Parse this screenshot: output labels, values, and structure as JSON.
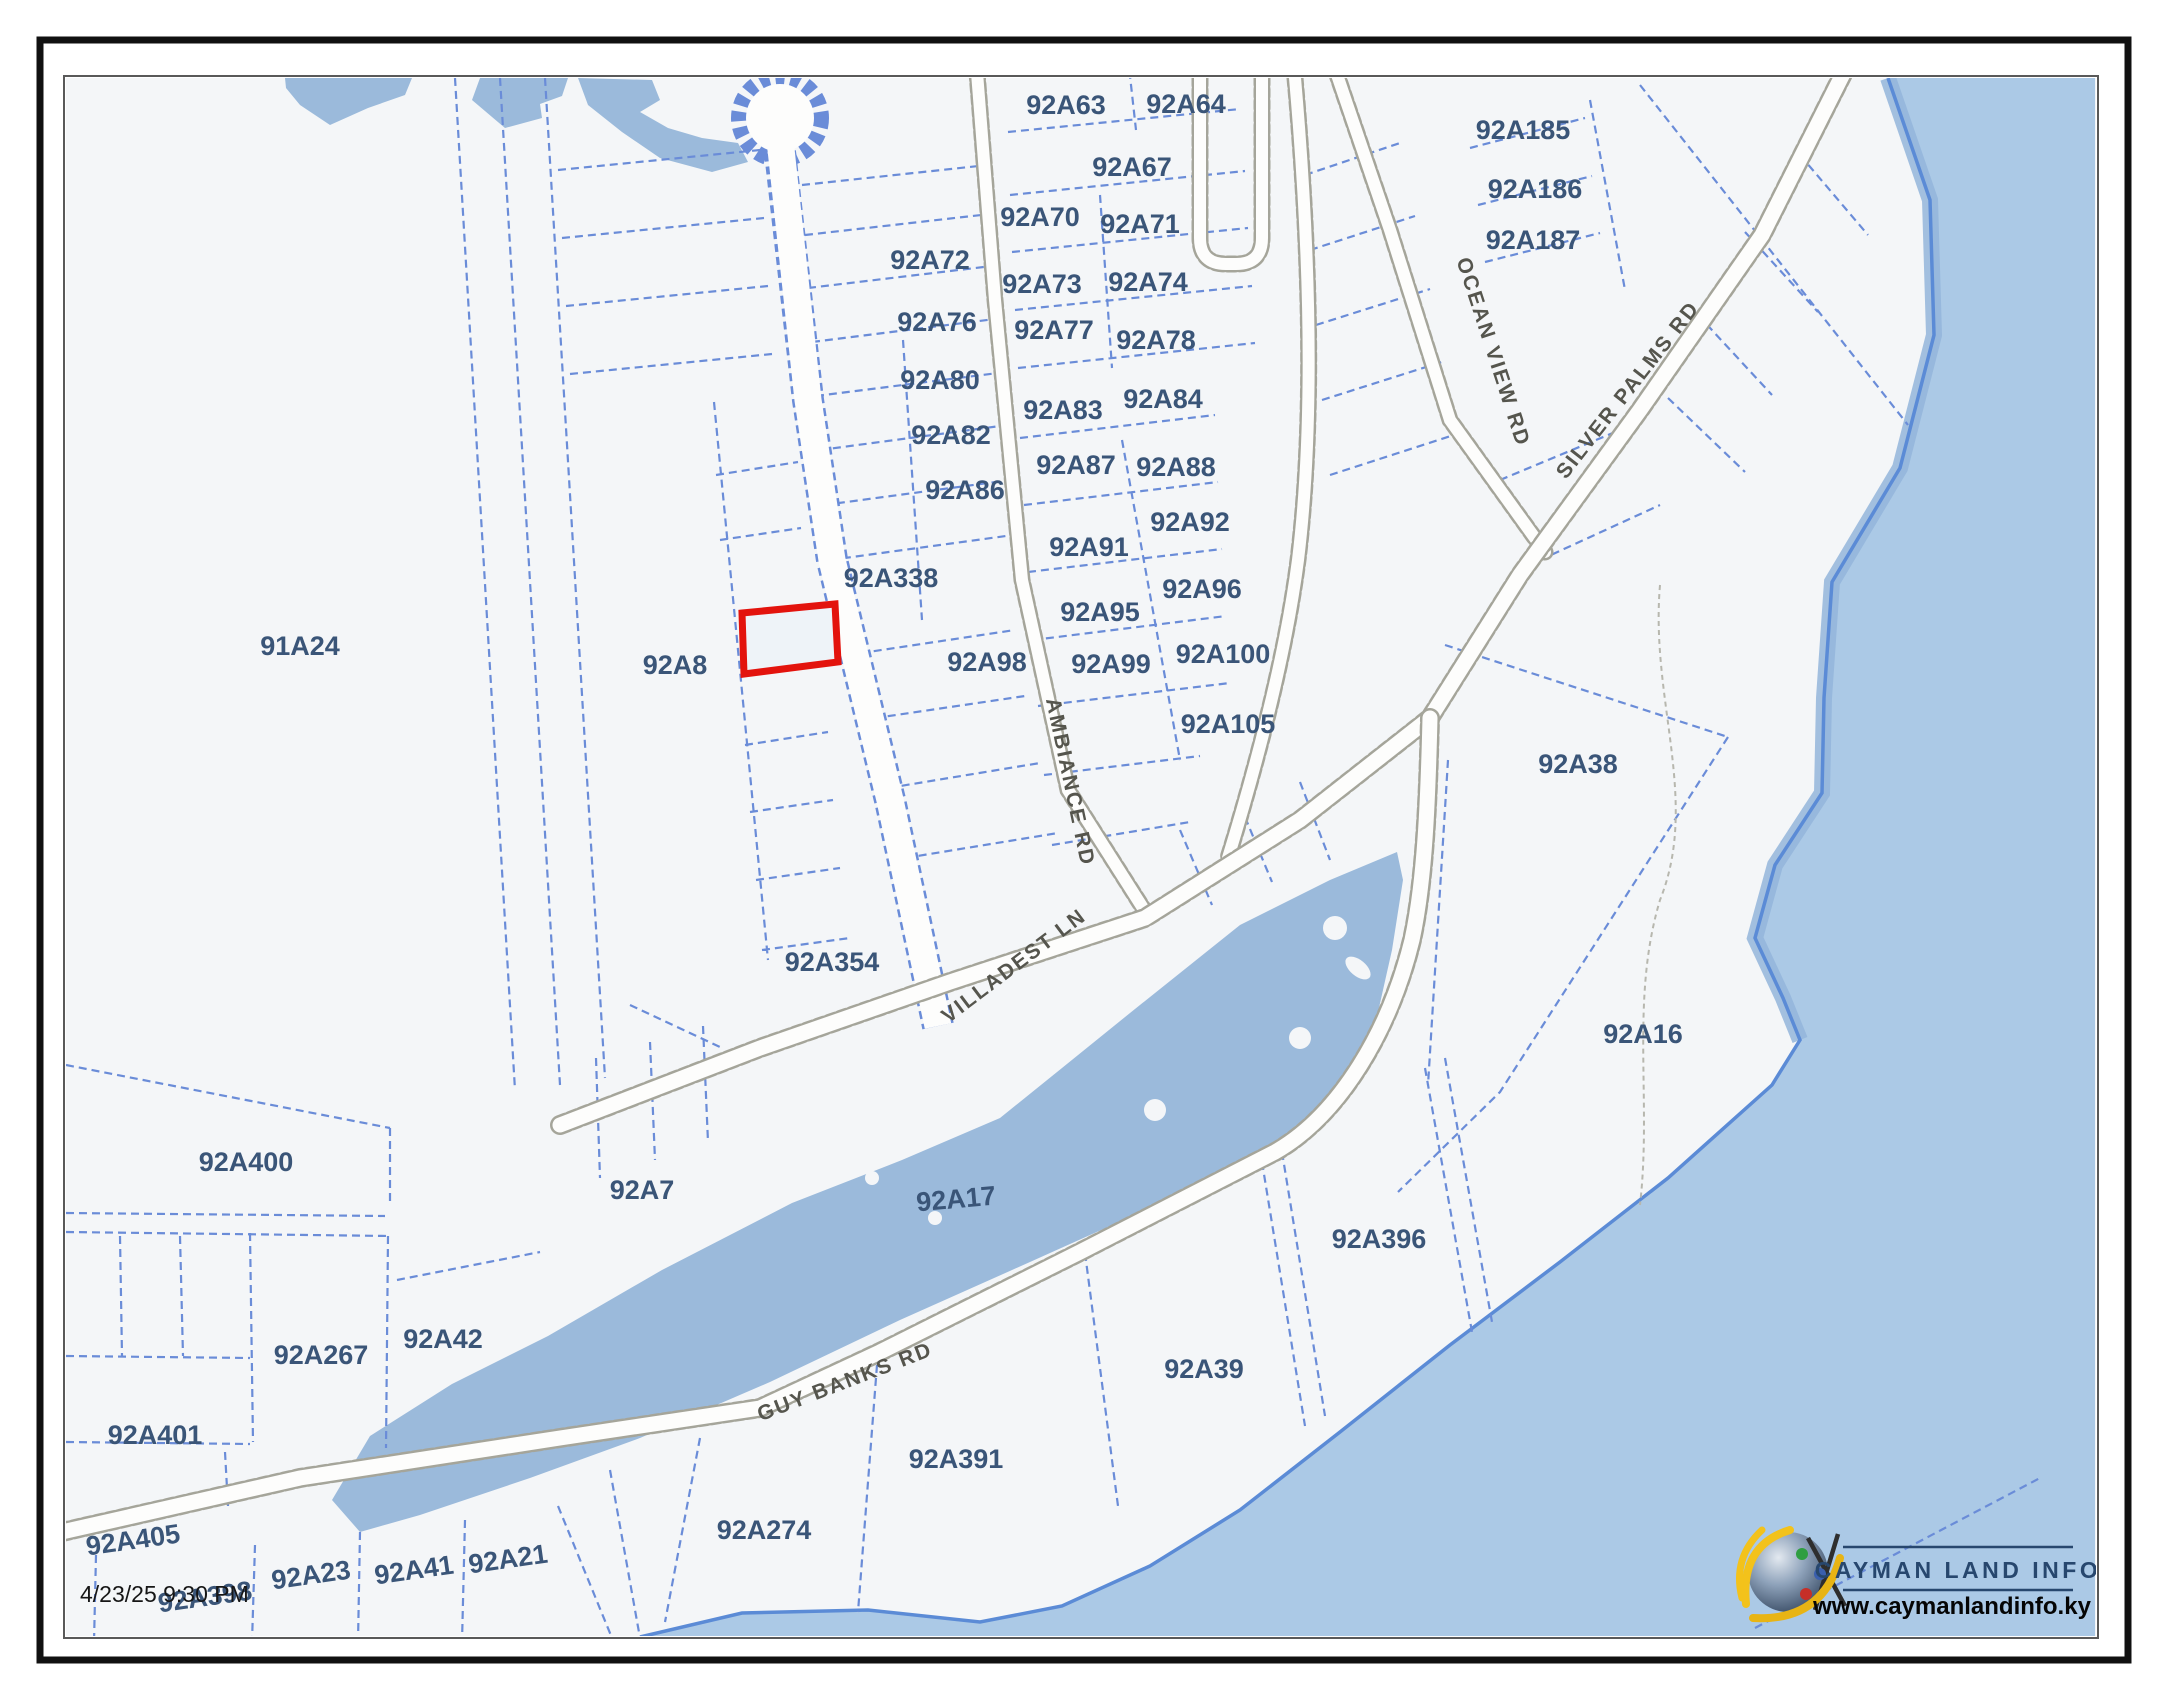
{
  "page": {
    "timestamp": "4/23/25 9:30 PM"
  },
  "map": {
    "colors": {
      "land": "#f4f6f8",
      "sea": "#abc9e6",
      "pond": "#9bbadb",
      "coastline": "#5b8bd6",
      "shore-band": "#93b5da",
      "parcel-line": "#6a8cd8",
      "road-casing": "#a5a59a",
      "road-fill": "#fdfdfc",
      "parcel-label": "#3a5578",
      "road-label": "#55554d",
      "highlight": "#e3130d",
      "frame": "#595959",
      "border": "#111111"
    },
    "highlight_parcel": {
      "points": "742,613 835,604 838,662 744,674"
    },
    "parcel_labels": [
      {
        "id": "91A24",
        "x": 300,
        "y": 646
      },
      {
        "id": "92A8",
        "x": 675,
        "y": 665
      },
      {
        "id": "92A338",
        "x": 891,
        "y": 578
      },
      {
        "id": "92A354",
        "x": 832,
        "y": 962
      },
      {
        "id": "92A63",
        "x": 1066,
        "y": 105
      },
      {
        "id": "92A64",
        "x": 1186,
        "y": 104
      },
      {
        "id": "92A67",
        "x": 1132,
        "y": 167
      },
      {
        "id": "92A70",
        "x": 1040,
        "y": 217
      },
      {
        "id": "92A71",
        "x": 1140,
        "y": 224
      },
      {
        "id": "92A72",
        "x": 930,
        "y": 260
      },
      {
        "id": "92A73",
        "x": 1042,
        "y": 284
      },
      {
        "id": "92A74",
        "x": 1148,
        "y": 282
      },
      {
        "id": "92A76",
        "x": 937,
        "y": 322
      },
      {
        "id": "92A77",
        "x": 1054,
        "y": 330
      },
      {
        "id": "92A78",
        "x": 1156,
        "y": 340
      },
      {
        "id": "92A80",
        "x": 940,
        "y": 380
      },
      {
        "id": "92A82",
        "x": 951,
        "y": 435
      },
      {
        "id": "92A83",
        "x": 1063,
        "y": 410
      },
      {
        "id": "92A84",
        "x": 1163,
        "y": 399
      },
      {
        "id": "92A86",
        "x": 965,
        "y": 490
      },
      {
        "id": "92A87",
        "x": 1076,
        "y": 465
      },
      {
        "id": "92A88",
        "x": 1176,
        "y": 467
      },
      {
        "id": "92A91",
        "x": 1089,
        "y": 547
      },
      {
        "id": "92A92",
        "x": 1190,
        "y": 522
      },
      {
        "id": "92A95",
        "x": 1100,
        "y": 612
      },
      {
        "id": "92A96",
        "x": 1202,
        "y": 589
      },
      {
        "id": "92A98",
        "x": 987,
        "y": 662
      },
      {
        "id": "92A99",
        "x": 1111,
        "y": 664
      },
      {
        "id": "92A100",
        "x": 1223,
        "y": 654
      },
      {
        "id": "92A105",
        "x": 1228,
        "y": 724
      },
      {
        "id": "92A185",
        "x": 1523,
        "y": 130
      },
      {
        "id": "92A186",
        "x": 1535,
        "y": 189
      },
      {
        "id": "92A187",
        "x": 1533,
        "y": 240
      },
      {
        "id": "92A38",
        "x": 1578,
        "y": 764
      },
      {
        "id": "92A16",
        "x": 1643,
        "y": 1034
      },
      {
        "id": "92A7",
        "x": 642,
        "y": 1190
      },
      {
        "id": "92A17",
        "x": 956,
        "y": 1199,
        "rotation": -5
      },
      {
        "id": "92A400",
        "x": 246,
        "y": 1162
      },
      {
        "id": "92A267",
        "x": 321,
        "y": 1355
      },
      {
        "id": "92A42",
        "x": 443,
        "y": 1339
      },
      {
        "id": "92A401",
        "x": 155,
        "y": 1435
      },
      {
        "id": "92A405",
        "x": 133,
        "y": 1540,
        "rotation": -8
      },
      {
        "id": "92A398",
        "x": 205,
        "y": 1597,
        "rotation": -8
      },
      {
        "id": "92A23",
        "x": 311,
        "y": 1575,
        "rotation": -8
      },
      {
        "id": "92A41",
        "x": 414,
        "y": 1570,
        "rotation": -8
      },
      {
        "id": "92A21",
        "x": 508,
        "y": 1559,
        "rotation": -8
      },
      {
        "id": "92A391",
        "x": 956,
        "y": 1459
      },
      {
        "id": "92A274",
        "x": 764,
        "y": 1530
      },
      {
        "id": "92A39",
        "x": 1204,
        "y": 1369
      },
      {
        "id": "92A396",
        "x": 1379,
        "y": 1239
      }
    ],
    "road_labels": [
      {
        "name": "OCEAN VIEW RD",
        "x": 1493,
        "y": 352,
        "rotation": 72
      },
      {
        "name": "SILVER PALMS RD",
        "x": 1628,
        "y": 390,
        "rotation": -52
      },
      {
        "name": "AMBIANCE RD",
        "x": 1070,
        "y": 782,
        "rotation": 78
      },
      {
        "name": "VILLADEST LN",
        "x": 1014,
        "y": 966,
        "rotation": -37
      },
      {
        "name": "GUY BANKS RD",
        "x": 845,
        "y": 1382,
        "rotation": -21
      }
    ]
  },
  "logo": {
    "title": "CAYMAN LAND INFO",
    "url": "www.caymanlandinfo.ky"
  }
}
